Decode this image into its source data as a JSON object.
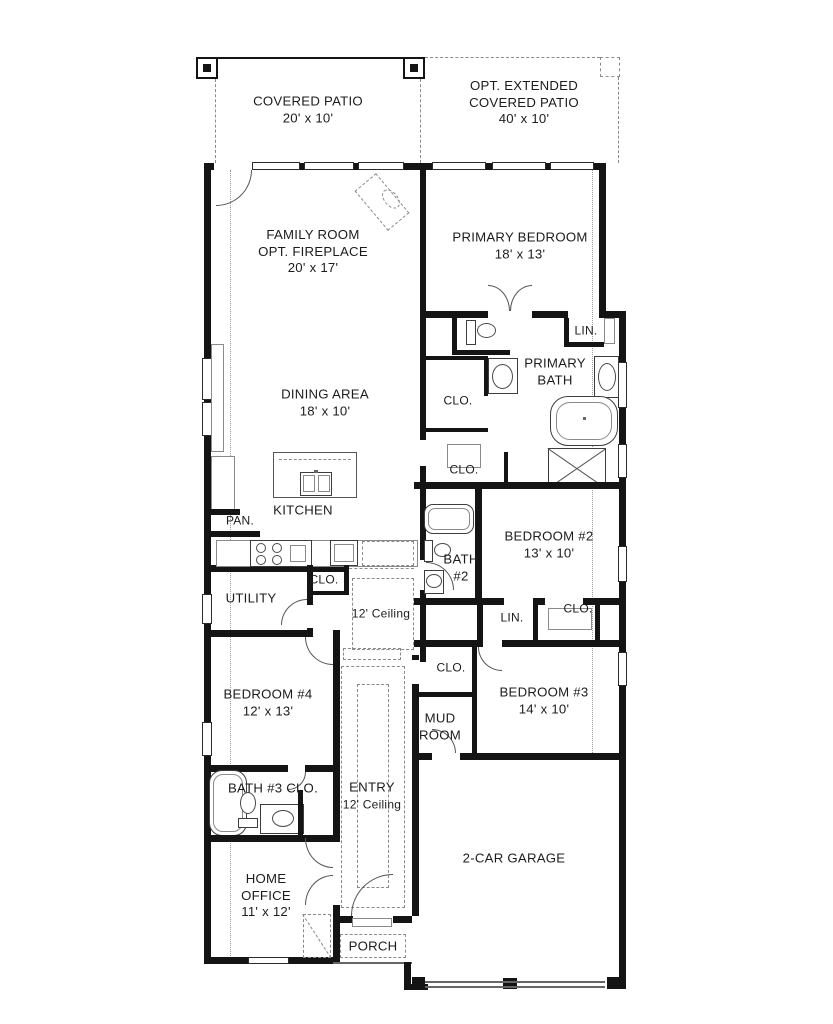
{
  "plan": {
    "type": "residential-floor-plan",
    "colors": {
      "background": "#ffffff",
      "walls": "#141414",
      "thin_lines": "#555555",
      "dashed_lines": "#8a8a8a",
      "text": "#1c1c1c"
    },
    "labels": {
      "covered_patio": {
        "l1": "COVERED PATIO",
        "l2": "20' x 10'"
      },
      "opt_patio": {
        "l1": "OPT. EXTENDED",
        "l2": "COVERED PATIO",
        "l3": "40' x 10'"
      },
      "family_room": {
        "l1": "FAMILY ROOM",
        "l2": "OPT. FIREPLACE",
        "l3": "20' x 17'"
      },
      "primary_bedroom": {
        "l1": "PRIMARY BEDROOM",
        "l2": "18' x 13'"
      },
      "lin_primary": {
        "l1": "LIN."
      },
      "primary_bath": {
        "l1": "PRIMARY",
        "l2": "BATH"
      },
      "clo_primary_1": {
        "l1": "CLO."
      },
      "clo_primary_2": {
        "l1": "CLO."
      },
      "dining": {
        "l1": "DINING AREA",
        "l2": "18' x 10'"
      },
      "kitchen": {
        "l1": "KITCHEN"
      },
      "pantry": {
        "l1": "PAN."
      },
      "bedroom2": {
        "l1": "BEDROOM #2",
        "l2": "13' x 10'"
      },
      "bath2": {
        "l1": "BATH",
        "l2": "#2"
      },
      "clo_hall": {
        "l1": "CLO."
      },
      "utility": {
        "l1": "UTILITY"
      },
      "hall_ceiling": {
        "l1": "12' Ceiling"
      },
      "lin_bed2": {
        "l1": "LIN."
      },
      "clo_bed2": {
        "l1": "CLO."
      },
      "clo_bed3": {
        "l1": "CLO."
      },
      "bedroom3": {
        "l1": "BEDROOM #3",
        "l2": "14' x 10'"
      },
      "bedroom4": {
        "l1": "BEDROOM #4",
        "l2": "12' x 13'"
      },
      "mud_room": {
        "l1": "MUD",
        "l2": "ROOM"
      },
      "bath3": {
        "l1": "BATH #3 CLO."
      },
      "entry": {
        "l1": "ENTRY",
        "l2": "12' Ceiling"
      },
      "garage": {
        "l1": "2-CAR GARAGE"
      },
      "home_office": {
        "l1": "HOME",
        "l2": "OFFICE",
        "l3": "11' x 12'"
      },
      "porch": {
        "l1": "PORCH"
      }
    }
  }
}
